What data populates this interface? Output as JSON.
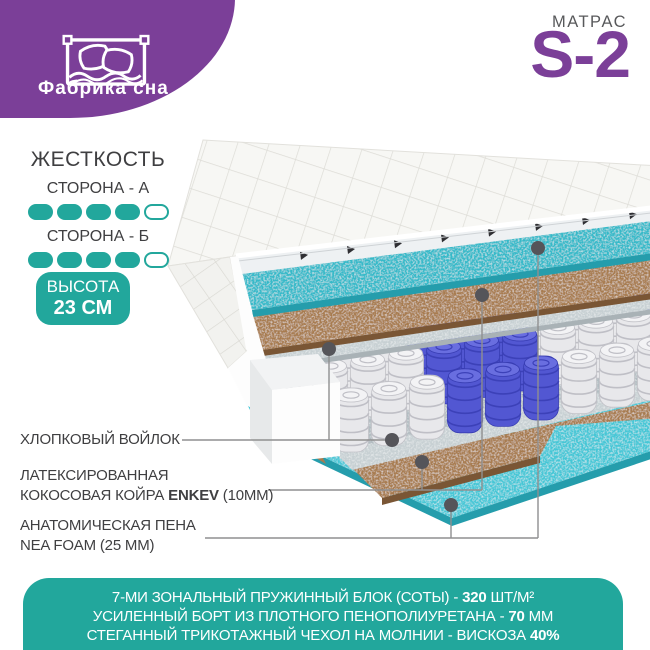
{
  "brand": {
    "logo_text": "Фабрика сна"
  },
  "product": {
    "label": "МАТРАС",
    "model": "S-2"
  },
  "firmness": {
    "title": "ЖЕСТКОСТЬ",
    "sides": [
      {
        "label": "СТОРОНА - А",
        "filled": 4,
        "total": 5
      },
      {
        "label": "СТОРОНА - Б",
        "filled": 4,
        "total": 5
      }
    ]
  },
  "height_badge": {
    "title": "ВЫСОТА",
    "value": "23 СМ"
  },
  "layer_labels": [
    {
      "id": "felt",
      "lines": [
        [
          {
            "t": "ХЛОПКОВЫЙ ВОЙЛОК",
            "b": false
          }
        ]
      ]
    },
    {
      "id": "coir",
      "lines": [
        [
          {
            "t": "ЛАТЕКСИРОВАННАЯ",
            "b": false
          }
        ],
        [
          {
            "t": "КОКОСОВАЯ КОЙРА ",
            "b": false
          },
          {
            "t": "ENKEV",
            "b": true
          },
          {
            "t": " (10ММ)",
            "b": false
          }
        ]
      ]
    },
    {
      "id": "foam",
      "lines": [
        [
          {
            "t": "АНАТОМИЧЕСКАЯ ПЕНА",
            "b": false
          }
        ],
        [
          {
            "t": "NEA FOAM (25 ММ)",
            "b": false
          }
        ]
      ]
    }
  ],
  "banner": {
    "lines": [
      [
        {
          "t": "7-МИ ЗОНАЛЬНЫЙ ПРУЖИННЫЙ БЛОК (СОТЫ) - ",
          "b": false
        },
        {
          "t": "320",
          "b": true
        },
        {
          "t": " ШТ/М²",
          "b": false
        }
      ],
      [
        {
          "t": "УСИЛЕННЫЙ БОРТ ИЗ ПЛОТНОГО ПЕНОПОЛИУРЕТАНА - ",
          "b": false
        },
        {
          "t": "70",
          "b": true
        },
        {
          "t": " ММ",
          "b": false
        }
      ],
      [
        {
          "t": "СТЕГАННЫЙ ТРИКОТАЖНЫЙ ЧЕХОЛ НА МОЛНИИ - ВИСКОЗА ",
          "b": false
        },
        {
          "t": "40%",
          "b": true
        }
      ]
    ]
  },
  "colors": {
    "purple": "#7b3f98",
    "teal": "#22a79c",
    "badge_bg": "#22a79c",
    "banner_bg": "#22a79c",
    "text_dark": "#3f3f41",
    "text_gray": "#58595b",
    "foam_top": "#35bac9",
    "foam_bottom": "#44c7d6",
    "coir": "#a87c50",
    "felt": "#c7d0d3",
    "spring_white": "#e8e8eb",
    "spring_blue": "#5257d2",
    "callout": "#8f8f90",
    "dot": "#55555a"
  }
}
